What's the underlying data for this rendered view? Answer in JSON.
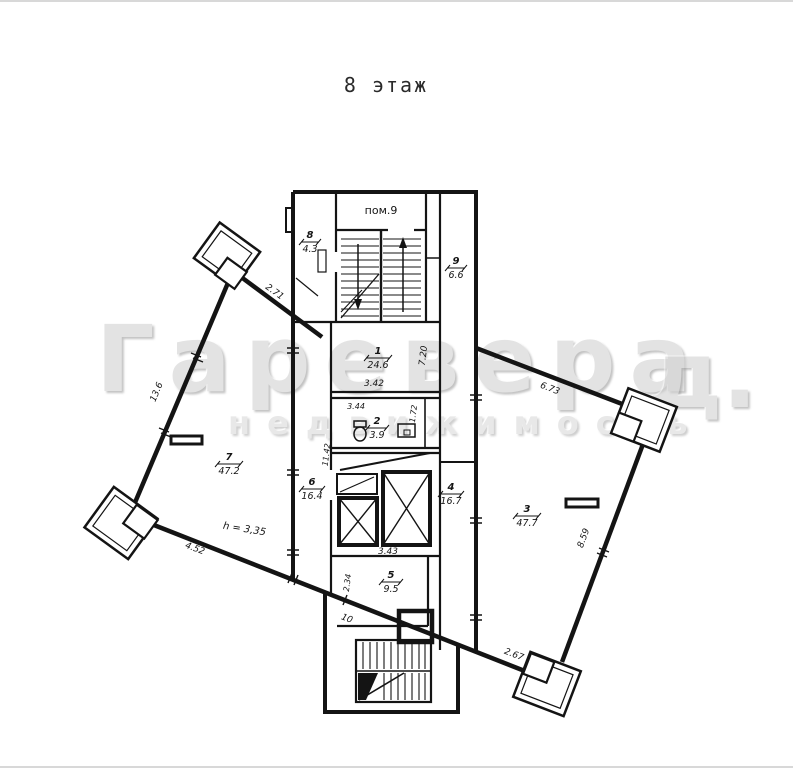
{
  "title": "8 этаж",
  "watermark": {
    "brand": "Гаревера",
    "brand_tail": "д.",
    "subtitle": "недвижимость"
  },
  "plan": {
    "vestibule_label": "пом.9",
    "height_note": "h = 3,35",
    "rooms": {
      "r1": {
        "num": "1",
        "area": "24.6"
      },
      "r2": {
        "num": "2",
        "area": "3.9"
      },
      "r3": {
        "num": "3",
        "area": "47.7"
      },
      "r4": {
        "num": "4",
        "area": "16.7"
      },
      "r5": {
        "num": "5",
        "area": "9.5"
      },
      "r6": {
        "num": "6",
        "area": "16.4"
      },
      "r7": {
        "num": "7",
        "area": "47.2"
      },
      "r8": {
        "num": "8",
        "area": "4.3"
      },
      "r9": {
        "num": "9",
        "area": "6.6"
      }
    },
    "dims": {
      "wing_left_top": "2.71",
      "wing_left_side": "13.6",
      "wing_left_bottom": "4.52",
      "facade_mid": "10",
      "room1_width": "3.42",
      "room2_width": "3.44",
      "room2_depth": "1.72",
      "corridor_right": "7.20",
      "corridor_left": "11.42",
      "room5_depth": "2.34",
      "room5_width": "3.43",
      "wing_right_top": "6.73",
      "wing_right_side": "8.59",
      "wing_right_bottom": "2.67"
    }
  }
}
